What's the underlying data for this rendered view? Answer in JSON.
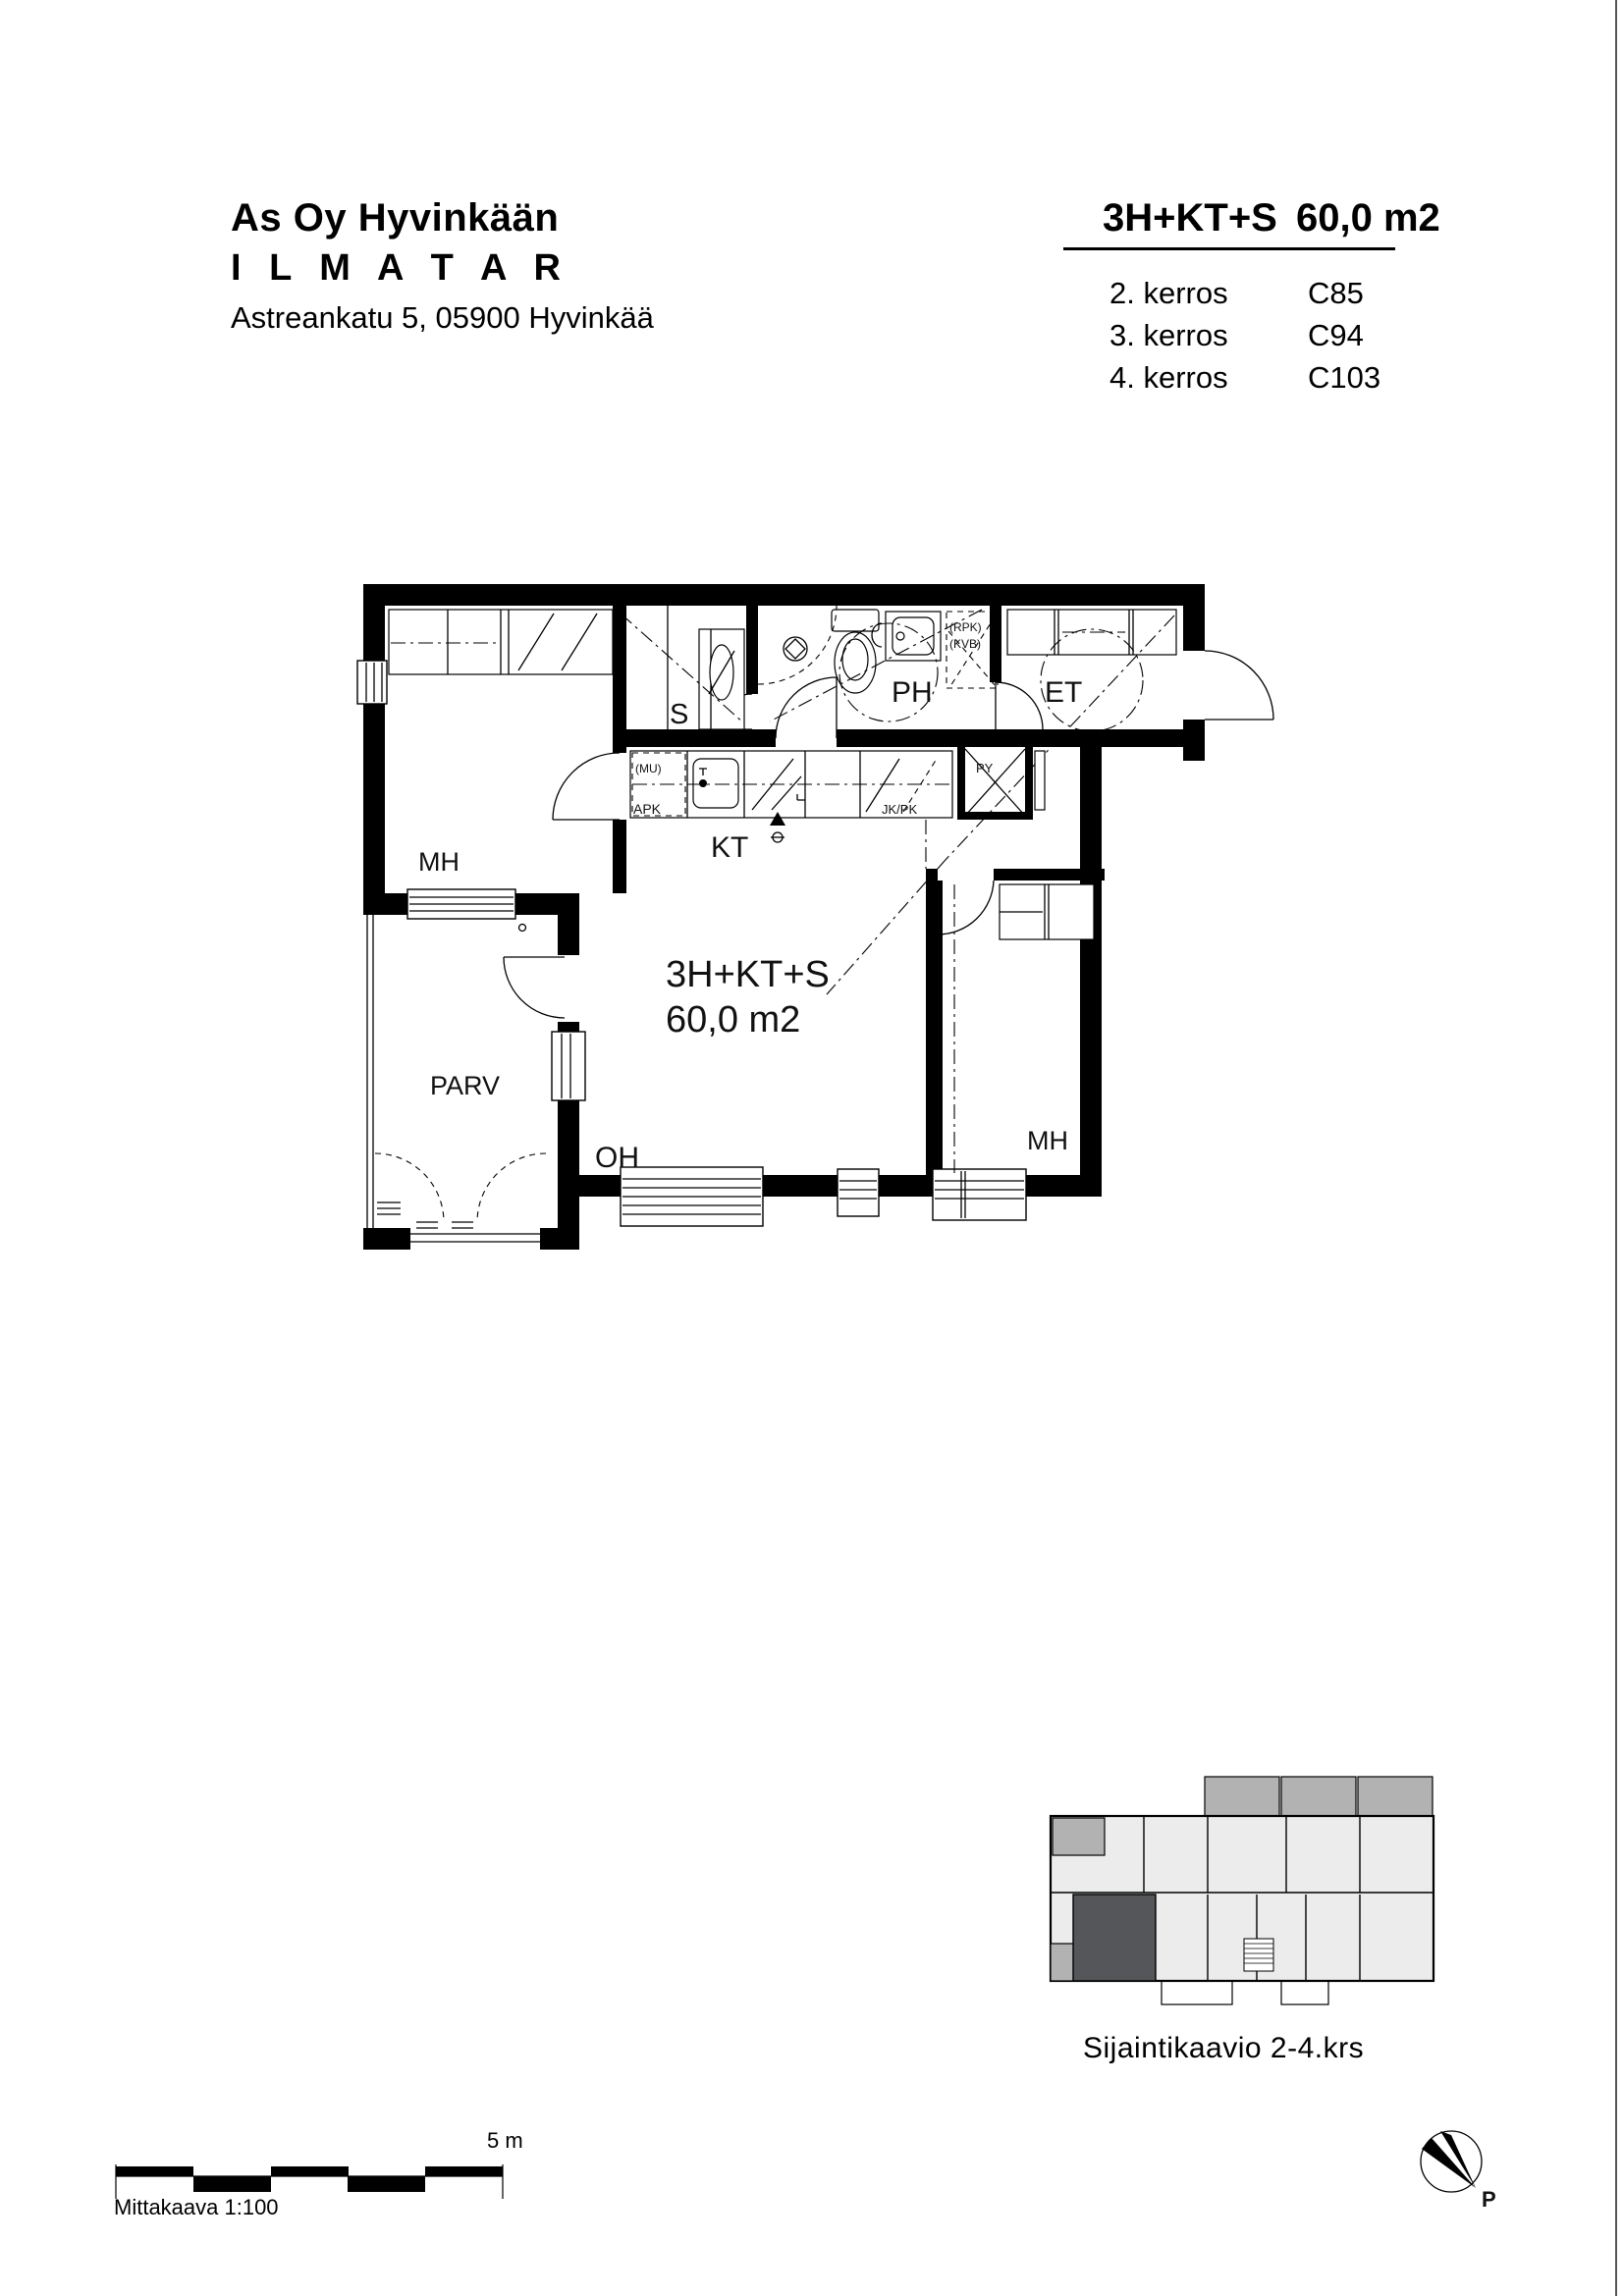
{
  "header": {
    "company_line1": "As Oy Hyvinkään",
    "company_line2": "I L M A T A R",
    "address": "Astreankatu 5, 05900 Hyvinkää"
  },
  "summary": {
    "apartment_type": "3H+KT+S",
    "area": "60,0 m2",
    "floors": [
      {
        "name": "2. kerros",
        "code": "C85"
      },
      {
        "name": "3. kerros",
        "code": "C94"
      },
      {
        "name": "4. kerros",
        "code": "C103"
      }
    ]
  },
  "plan": {
    "labels": {
      "bedroom1": "MH",
      "sauna": "S",
      "bathroom": "PH",
      "entrance": "ET",
      "kitchen": "KT",
      "living_room": "OH",
      "bedroom2": "MH",
      "balcony": "PARV",
      "type": "3H+KT+S",
      "area": "60,0 m2"
    },
    "appliances": {
      "mu": "(MU)",
      "apk": "APK",
      "jkpk": "JK/PK",
      "py": "PY",
      "rpk": "(RPK)",
      "kvb": "(KVB)"
    }
  },
  "site": {
    "caption": "Sijaintikaavio  2-4.krs",
    "floor_color": "#ececec",
    "balcony_color": "#b2b2b2",
    "highlight_color": "#55565a"
  },
  "scale_bar": {
    "length_label": "5 m",
    "caption": "Mittakaava 1:100"
  },
  "north": {
    "label": "P"
  }
}
